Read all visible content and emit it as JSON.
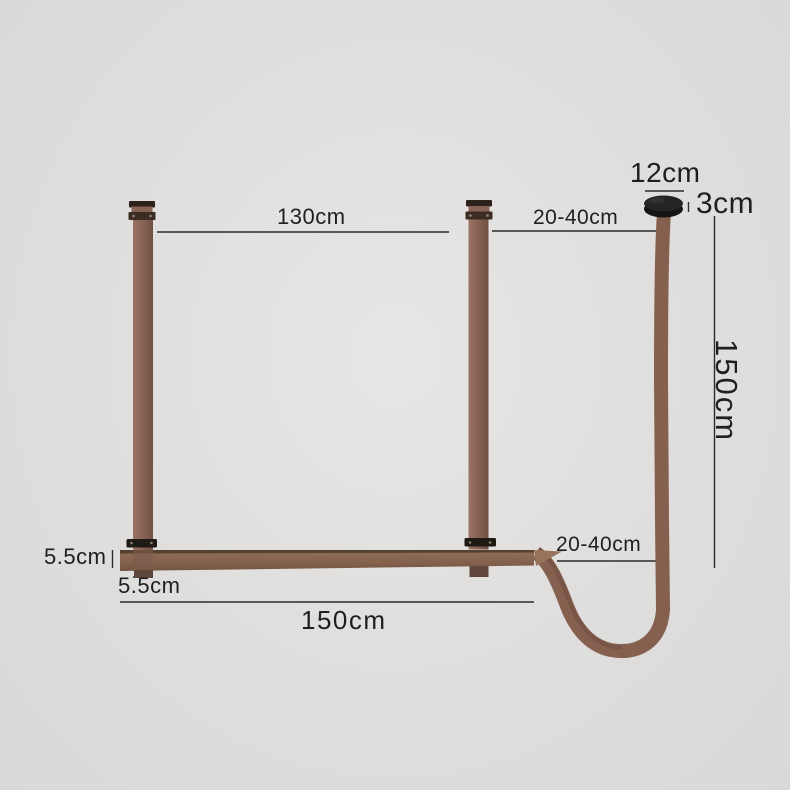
{
  "scene": {
    "title": "Leather strap pendant hanger dimension diagram",
    "background_color": "#e0dfdd"
  },
  "labels": {
    "span_between_straps": "130cm",
    "top_adjustable_gap": "20-40cm",
    "canopy_diameter": "12cm",
    "canopy_thickness": "3cm",
    "cord_drop_height": "150cm",
    "bottom_adjustable_gap": "20-40cm",
    "bar_height": "5.5cm",
    "strap_width": "5.5cm",
    "bar_length": "150cm"
  },
  "colors": {
    "strap_brown": "#8a6355",
    "strap_dark_edge": "#6f5043",
    "buckle_black": "#3b2c24",
    "canopy_black": "#1d1d1d",
    "dimension_line": "#2b2b2b",
    "text": "#1f1f1f"
  }
}
